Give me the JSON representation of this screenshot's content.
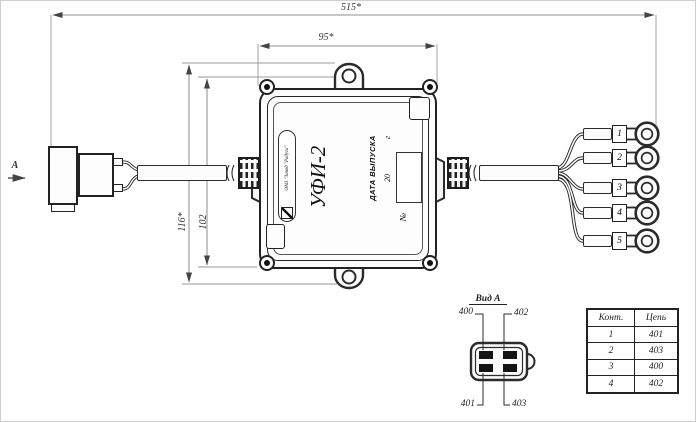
{
  "dimensions": {
    "overall_length": "515*",
    "box_width": "95*",
    "overall_height": "116*",
    "box_height": "102"
  },
  "view_arrow_label": "А",
  "device": {
    "manufacturer": "ОАО \"Завод \"Радуга\"",
    "model": "УФИ-2",
    "date_label": "ДАТА ВЫПУСКА",
    "date_year_prefix": "20",
    "date_year_suffix": "г",
    "serial_label": "№"
  },
  "terminals": {
    "labels": [
      "1",
      "2",
      "3",
      "4",
      "5"
    ]
  },
  "detail_view": {
    "title": "Вид А",
    "pin_top_left": "400",
    "pin_top_right": "402",
    "pin_bottom_left": "401",
    "pin_bottom_right": "403"
  },
  "pin_table": {
    "headers": [
      "Конт.",
      "Цепь"
    ],
    "rows": [
      [
        "1",
        "401"
      ],
      [
        "2",
        "403"
      ],
      [
        "3",
        "400"
      ],
      [
        "4",
        "402"
      ]
    ]
  },
  "colors": {
    "line": "#2b2b2b",
    "dimension": "#8c8c8c",
    "background": "#ffffff"
  }
}
